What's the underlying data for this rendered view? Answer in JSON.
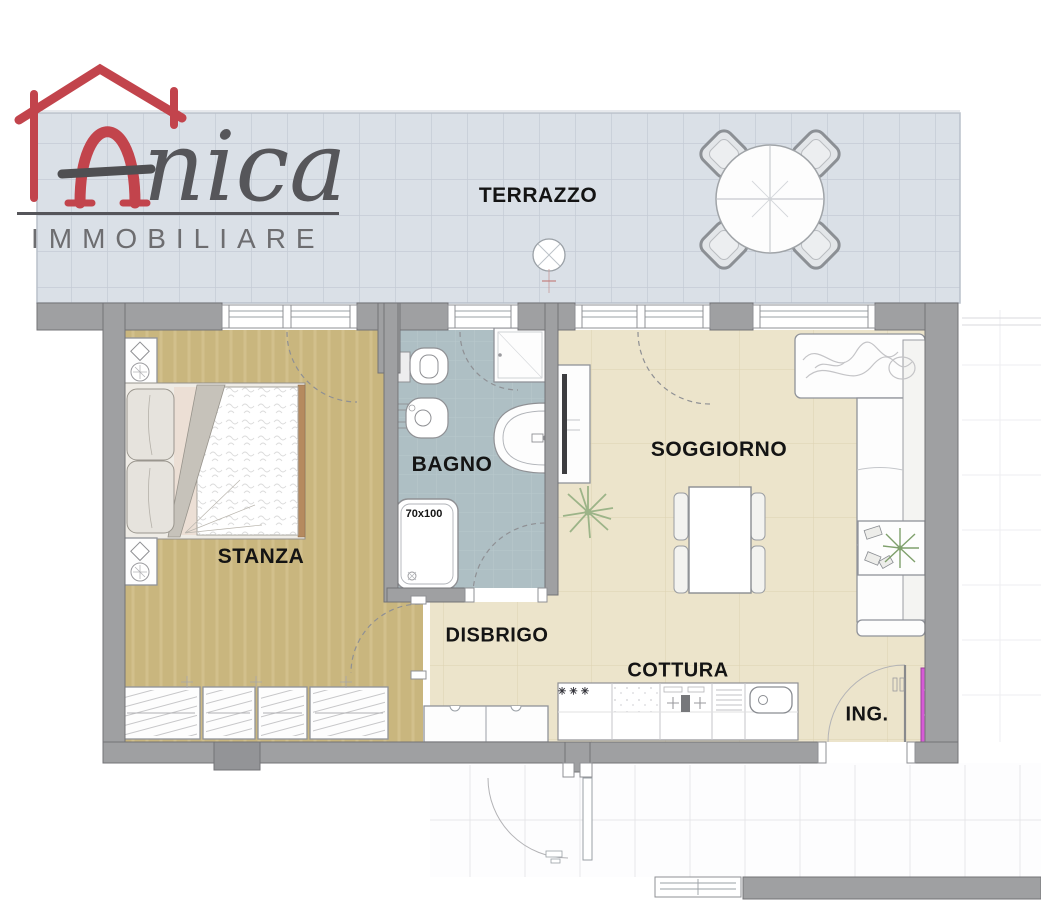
{
  "logo": {
    "name": "Anica",
    "name_initial": "A",
    "name_rest": "nica",
    "subtitle": "IMMOBILIARE"
  },
  "rooms": {
    "terrazzo": {
      "label": "TERRAZZO"
    },
    "stanza": {
      "label": "STANZA"
    },
    "bagno": {
      "label": "BAGNO",
      "shower_size": "70x100"
    },
    "disbrigo": {
      "label": "DISBRIGO"
    },
    "soggiorno": {
      "label": "SOGGIORNO"
    },
    "cottura": {
      "label": "COTTURA",
      "freezer_symbol": "✳✳✳"
    },
    "ingresso": {
      "label": "ING."
    }
  },
  "colors": {
    "logo_red": "#c2444c",
    "logo_gray": "#58585a",
    "terrace_floor": "#dae0e7",
    "bedroom_floor": "#c9b67e",
    "bathroom_floor": "#aebfc4",
    "living_floor": "#ece4cb",
    "wall_gray": "#9fa0a2",
    "highlight_magenta": "#d65bd6"
  }
}
